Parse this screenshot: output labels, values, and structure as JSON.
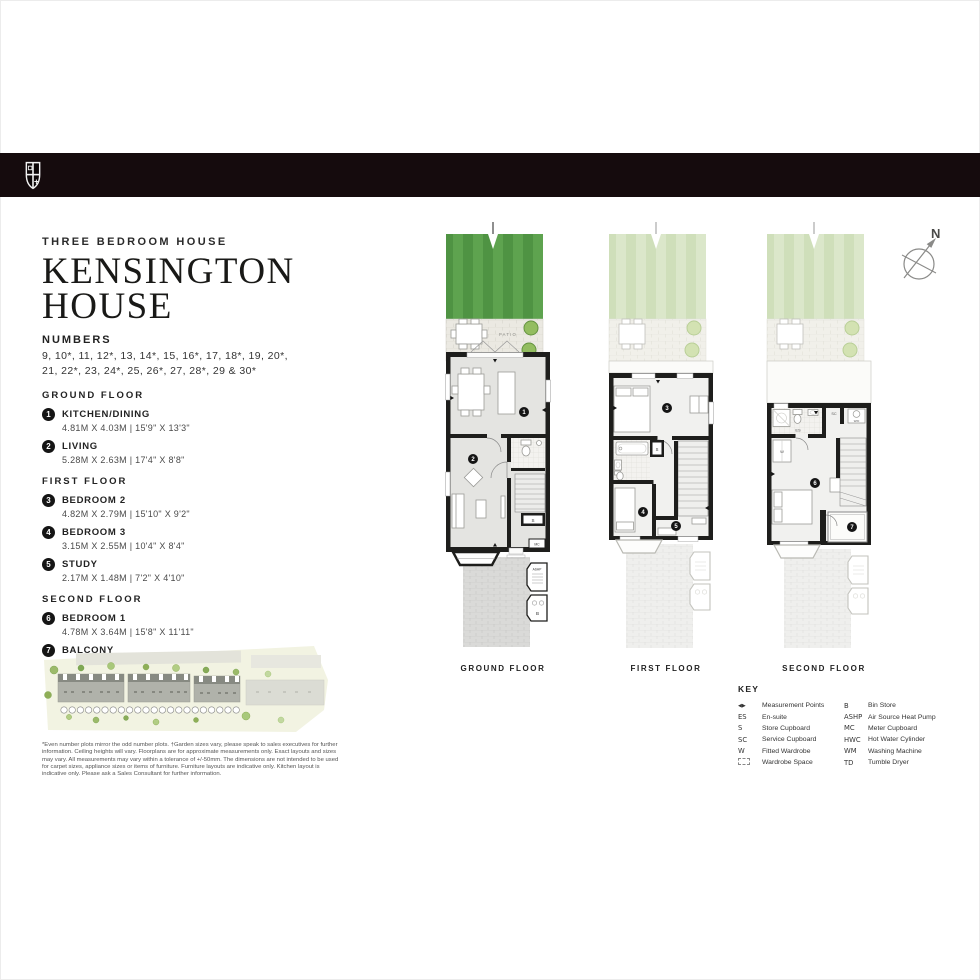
{
  "header": {
    "type_label": "THREE BEDROOM HOUSE",
    "title_line1": "KENSINGTON",
    "title_line2": "HOUSE",
    "numbers_heading": "NUMBERS",
    "numbers_line1": "9, 10*, 11, 12*, 13, 14*, 15, 16*, 17, 18*, 19, 20*,",
    "numbers_line2": "21, 22*, 23, 24*, 25, 26*, 27, 28*, 29 & 30*"
  },
  "room_list": {
    "sections": [
      {
        "heading": "GROUND FLOOR",
        "rooms": [
          {
            "num": "1",
            "name": "KITCHEN/DINING",
            "dims": "4.81M X 4.03M  |  15'9\" X 13'3\""
          },
          {
            "num": "2",
            "name": "LIVING",
            "dims": "5.28M X 2.63M  |  17'4\" X 8'8\""
          }
        ]
      },
      {
        "heading": "FIRST FLOOR",
        "rooms": [
          {
            "num": "3",
            "name": "BEDROOM 2",
            "dims": "4.82M X 2.79M  |  15'10\" X 9'2\""
          },
          {
            "num": "4",
            "name": "BEDROOM 3",
            "dims": "3.15M X 2.55M  |  10'4\" X 8'4\""
          },
          {
            "num": "5",
            "name": "STUDY",
            "dims": "2.17M X 1.48M  |  7'2\" X 4'10\""
          }
        ]
      },
      {
        "heading": "SECOND FLOOR",
        "rooms": [
          {
            "num": "6",
            "name": "BEDROOM 1",
            "dims": "4.78M X 3.64M  |  15'8\" X 11'11\""
          },
          {
            "num": "7",
            "name": "BALCONY",
            "dims": "1.89M X 1.66M  |  6'2\" X 5'5\""
          }
        ]
      }
    ]
  },
  "plans": {
    "ground": {
      "caption": "GROUND FLOOR",
      "patio_label": "PATIO",
      "marker_kitchen": "1",
      "marker_living": "2",
      "store_label": "S",
      "meter_label": "MC",
      "ashp_label": "ASHP",
      "bin_label": "B"
    },
    "first": {
      "caption": "FIRST FLOOR",
      "marker_bed2": "3",
      "marker_bed3": "4",
      "marker_study": "5",
      "store_label": "S"
    },
    "second": {
      "caption": "SECOND FLOOR",
      "ensuite_label": "ES",
      "wardrobe_label": "W",
      "service_label": "SC",
      "washer_label": "W/D",
      "marker_bed1": "6",
      "marker_balcony": "7"
    }
  },
  "compass": {
    "north_label": "N"
  },
  "key": {
    "heading": "KEY",
    "left": [
      {
        "symbol": "◀▶",
        "label": "Measurement Points"
      },
      {
        "symbol": "ES",
        "label": "En-suite"
      },
      {
        "symbol": "S",
        "label": "Store Cupboard"
      },
      {
        "symbol": "SC",
        "label": "Service Cupboard"
      },
      {
        "symbol": "W",
        "label": "Fitted Wardrobe"
      },
      {
        "symbol": "▭",
        "label": "Wardrobe Space"
      }
    ],
    "right": [
      {
        "symbol": "B",
        "label": "Bin Store"
      },
      {
        "symbol": "ASHP",
        "label": "Air Source Heat Pump"
      },
      {
        "symbol": "MC",
        "label": "Meter Cupboard"
      },
      {
        "symbol": "HWC",
        "label": "Hot Water Cylinder"
      },
      {
        "symbol": "WM",
        "label": "Washing Machine"
      },
      {
        "symbol": "TD",
        "label": "Tumble Dryer"
      }
    ]
  },
  "disclaimer": "*Even number plots mirror the odd number plots. †Garden sizes vary, please speak to sales executives for further information. Ceiling heights will vary. Floorplans are for approximate measurements only. Exact layouts and sizes may vary. All measurements may vary within a tolerance of +/-50mm. The dimensions are not intended to be used for carpet sizes, appliance sizes or items of furniture. Furniture layouts are indicative only. Kitchen layout is indicative only. Please ask a Sales Consultant for further information.",
  "colors": {
    "topbar": "#150b0d",
    "wall": "#1e1e1c",
    "lawn_dark": "#4f9343",
    "lawn_light": "#5ea34f",
    "lawn_faded_dark": "#cfdfba",
    "lawn_faded_light": "#dbe7ca",
    "bush": "#93bd60",
    "marker": "#151515"
  }
}
